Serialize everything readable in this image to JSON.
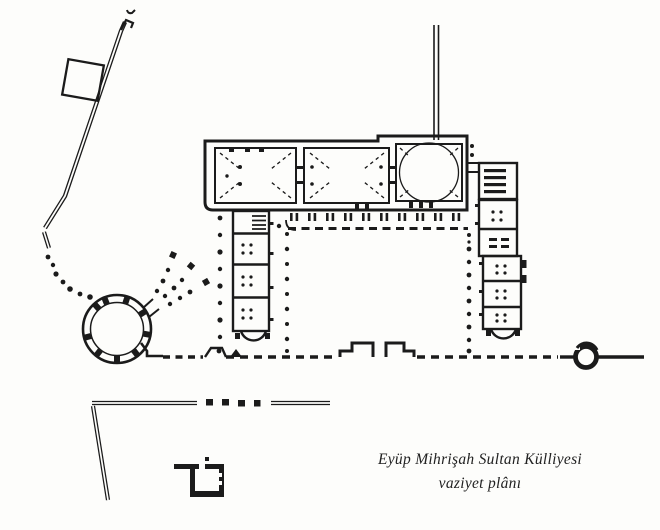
{
  "page": {
    "background": "#fdfdfb",
    "ink": "#1b1b1b"
  },
  "caption": {
    "line1": "Eyüp Mihrişah Sultan Külliyesi",
    "line2": "vaziyet plânı"
  },
  "plan": {
    "type": "architectural-site-plan",
    "features": [
      "access-road",
      "roadside-plot",
      "approach-dotted-path",
      "tomb-rotunda",
      "tomb-colonnade-rays",
      "domed-halls-block",
      "aqueduct-line",
      "courtyard-colonnade",
      "left-cell-wing",
      "right-cell-wing",
      "stair-hall",
      "street-wall",
      "courtyard-gate",
      "fountain-ring",
      "boundary-wall-southwest",
      "small-pavilion"
    ]
  }
}
